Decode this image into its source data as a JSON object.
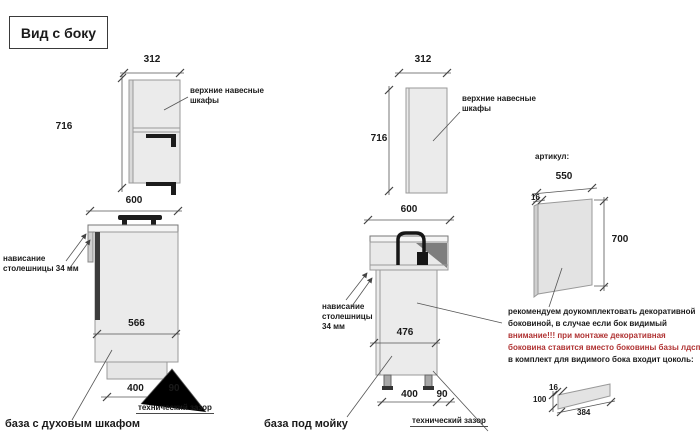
{
  "title": "Вид с боку",
  "colors": {
    "warning_text": "#b03333",
    "line": "#444444",
    "cabinet_fill": "#ebebeb"
  },
  "left_upper": {
    "width": "312",
    "height": "716",
    "label": "верхние навесные шкафы"
  },
  "left_base": {
    "width": "600",
    "depth": "566",
    "plinth_width": "400",
    "gap": "90",
    "overhang_label": "нависание столешницы 34 мм",
    "tech_gap_label": "технический зазор",
    "caption": "база с духовым шкафом"
  },
  "middle_upper": {
    "width": "312",
    "height": "716",
    "label": "верхние навесные шкафы"
  },
  "middle_base": {
    "width": "600",
    "depth": "476",
    "plinth_width": "400",
    "gap": "90",
    "overhang_label": "нависание столешницы 34 мм",
    "tech_gap_label": "технический зазор",
    "caption": "база под мойку"
  },
  "right": {
    "article_label": "артикул:",
    "side_panel": {
      "width": "550",
      "thickness": "16",
      "height": "700"
    },
    "note_line1": "рекомендуем доукомплектовать декоративной",
    "note_line2": "боковиной, в случае если бок видимый",
    "warning_line1": "внимание!!! при монтаже декоративная",
    "warning_line2": "боковина ставится вместо боковины базы лдсп",
    "note_line3": "в комплект для видимого бока входит цоколь:",
    "plinth": {
      "thickness": "16",
      "height": "100",
      "length": "384"
    }
  }
}
